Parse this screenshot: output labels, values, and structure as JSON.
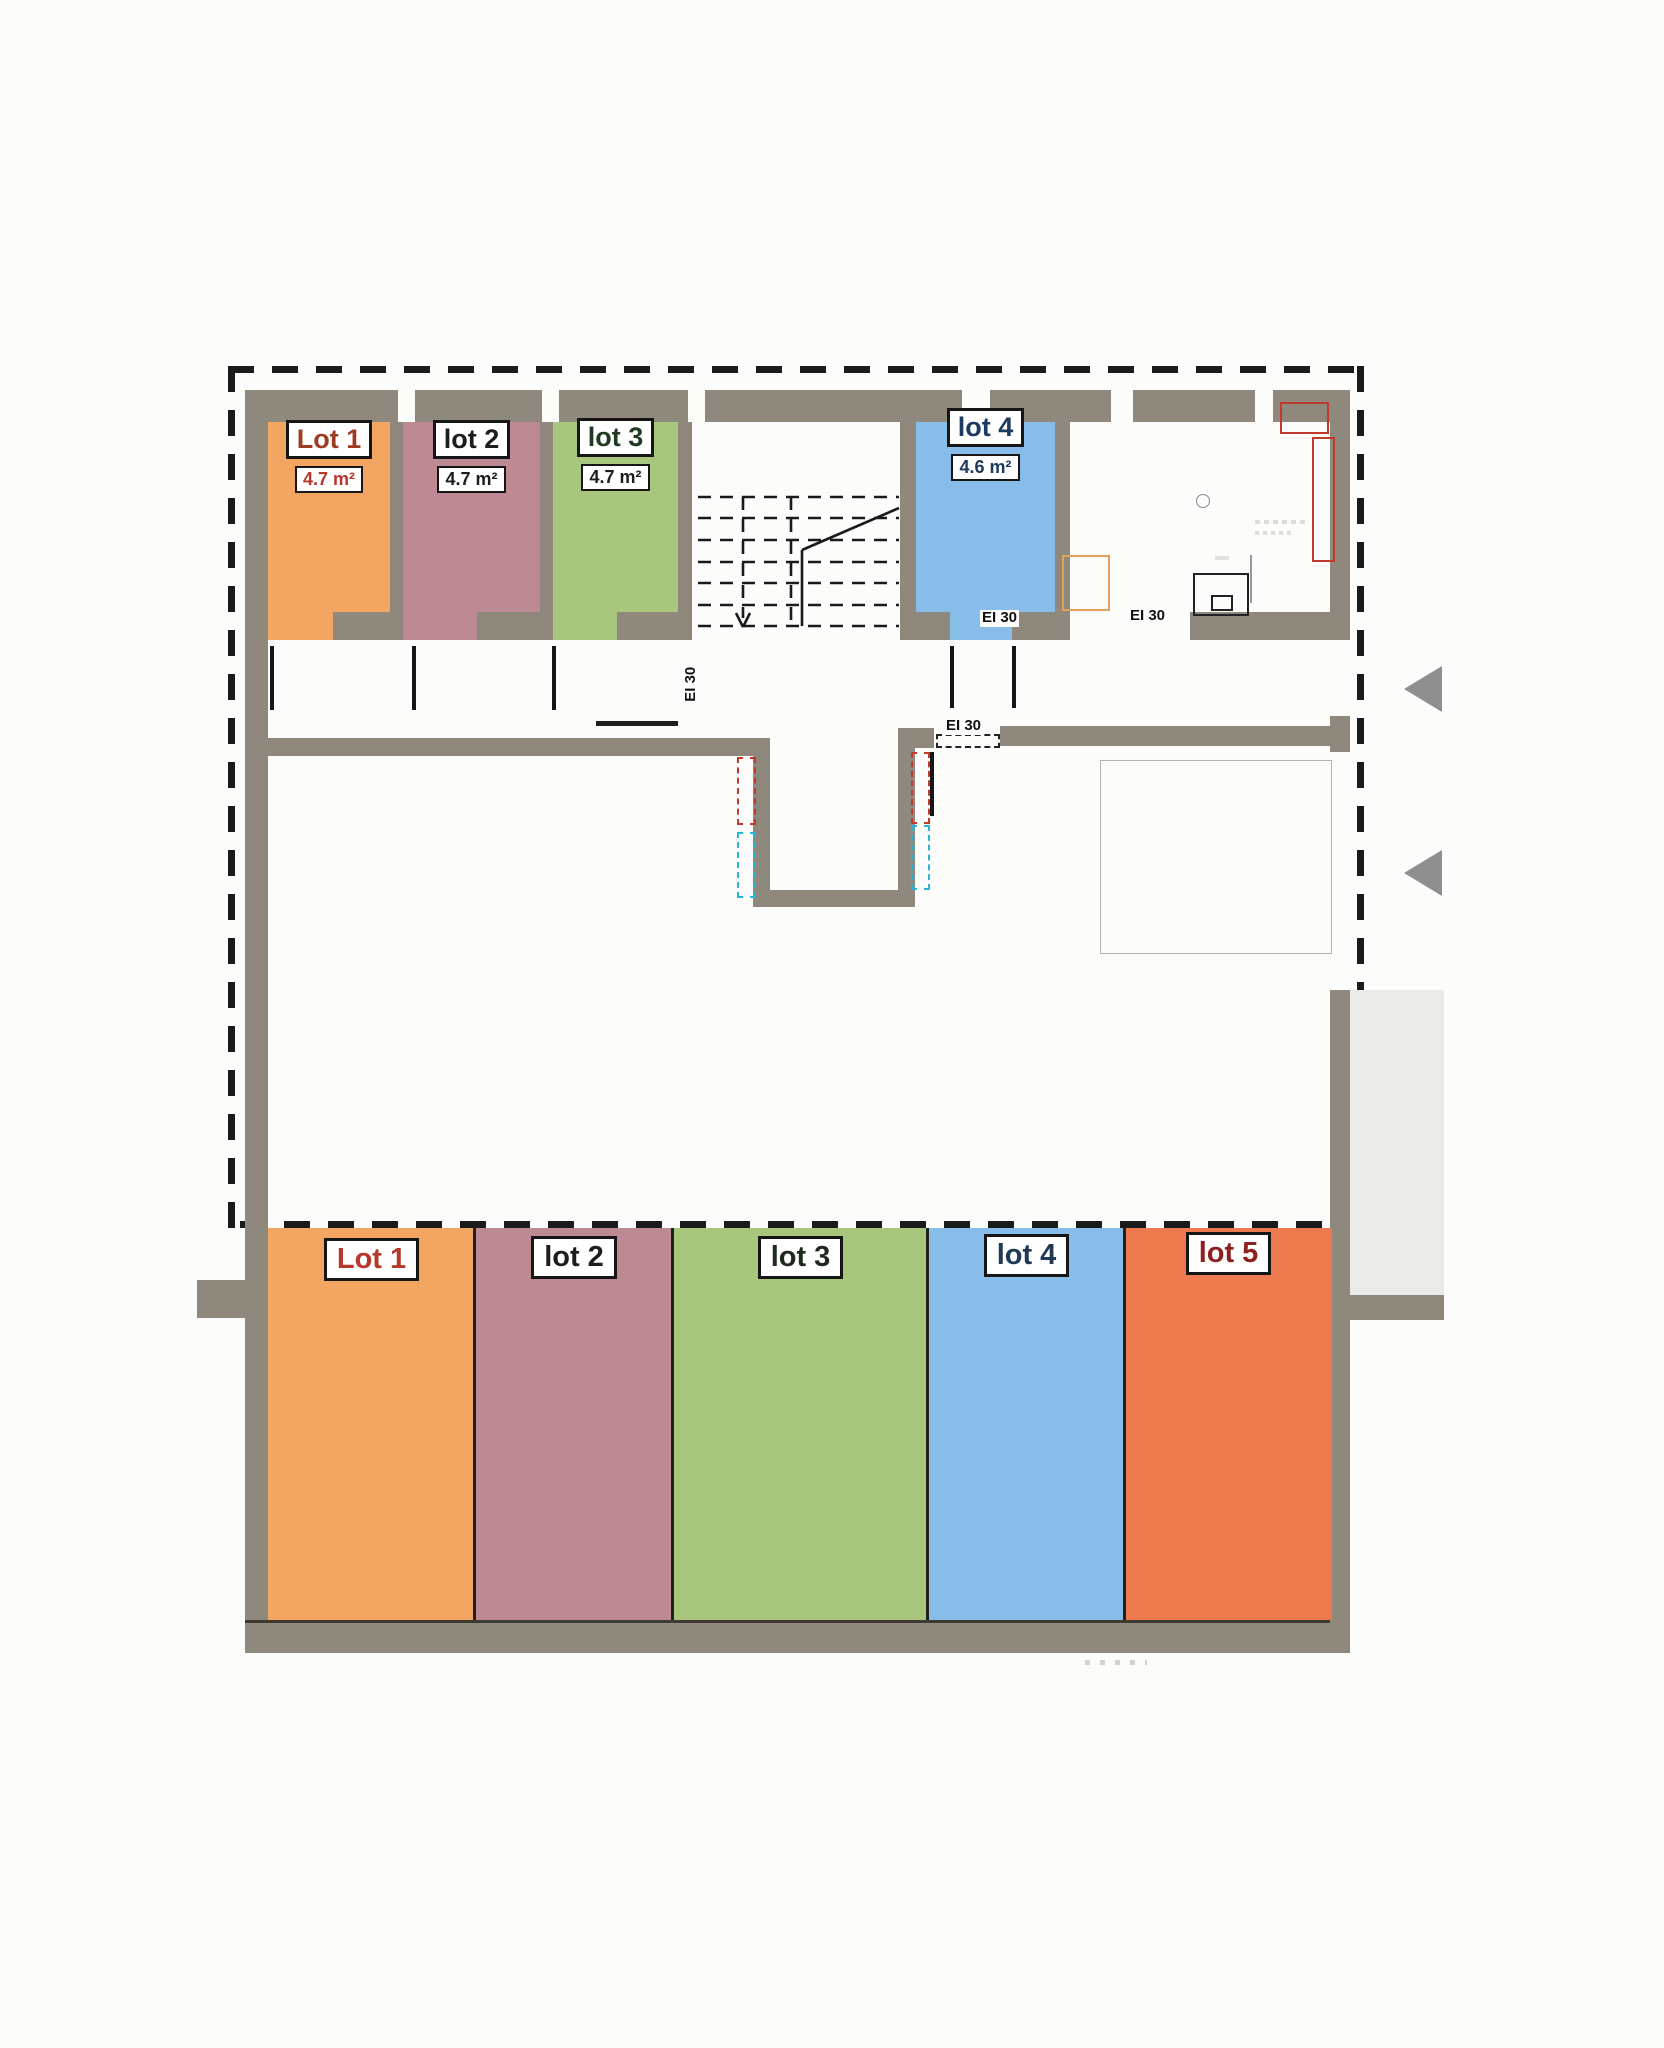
{
  "plan": {
    "upper_rooms": [
      {
        "label": "Lot 1",
        "area": "4.7 m²",
        "color": "#f2a661"
      },
      {
        "label": "lot 2",
        "area": "4.7 m²",
        "color": "#bd8992"
      },
      {
        "label": "lot 3",
        "area": "4.7 m²",
        "color": "#a8c77d"
      },
      {
        "label": "lot 4",
        "area": "4.6 m²",
        "color": "#88bce9"
      }
    ],
    "fire_labels": [
      "EI 30",
      "EI 30",
      "EI 30",
      "EI 30"
    ],
    "parking": [
      {
        "label": "Lot 1",
        "color": "#f2a661"
      },
      {
        "label": "lot 2",
        "color": "#bd8992"
      },
      {
        "label": "lot 3",
        "color": "#a8c77d"
      },
      {
        "label": "lot 4",
        "color": "#88bce9"
      },
      {
        "label": "lot 5",
        "color": "#ee7a50"
      }
    ],
    "colors": {
      "wall": "#8e897c",
      "boundary": "#1b1b1b",
      "ramp": "#eaeae8",
      "marker_red": "#c0392b",
      "marker_cyan": "#2ab6d9"
    }
  }
}
